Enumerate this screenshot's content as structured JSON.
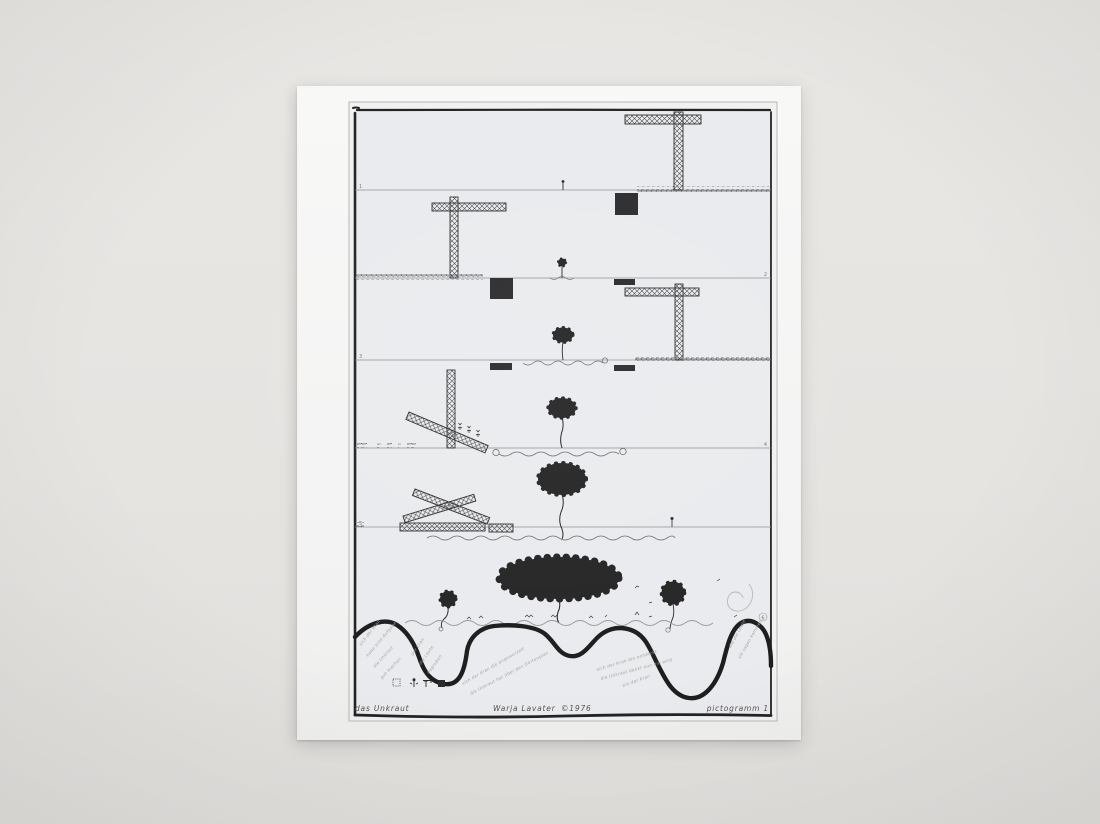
{
  "scene": {
    "background_hex": "#e6e4e1",
    "paper_hex": "#f6f6f5",
    "print_surface_hex": "#ebecee",
    "ink_hex": "#2a2a2a",
    "faint_line_hex": "#8f8f8d",
    "handwriting_hex": "#a4a39d"
  },
  "artwork": {
    "title_caption": "das Unkraut",
    "artist_caption": "Warja Lavater",
    "copyright_caption": "©1976",
    "series_caption": "pictogramm  1",
    "panel_numbers": [
      "1",
      "2",
      "3",
      "4",
      "5",
      "6"
    ],
    "legend_icons": [
      "dotted-square",
      "weed-sprout",
      "crane",
      "building-block"
    ],
    "handwriting": [
      "sich der Kran",
      "habe eine Aufgabe",
      "die Unkraut",
      "gut machen",
      "der Kran",
      "die Leute",
      "begruben",
      "sich der Kran die angewurzelt",
      "die Unkraut hat über den Gartenplan",
      "sich der Kran bin entdeckt",
      "die Unkraut denkt nun ein wird",
      "ein der Kran",
      "die die Leute",
      "sie sagen kommen"
    ]
  }
}
